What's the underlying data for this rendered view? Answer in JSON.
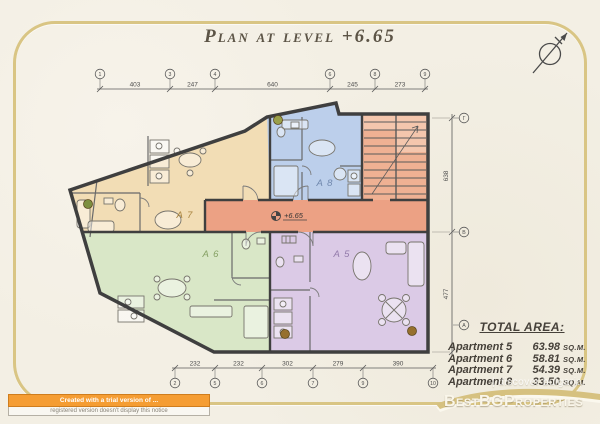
{
  "title": "Plan at level +6.65",
  "plan": {
    "level_marker": "+6.65",
    "apartments": [
      {
        "label": "A 5"
      },
      {
        "label": "A 6"
      },
      {
        "label": "A 7"
      },
      {
        "label": "A 8"
      }
    ]
  },
  "dims": {
    "top": {
      "segments": [
        "403",
        "247",
        "640",
        "245",
        "273"
      ],
      "grid": [
        "1",
        "3",
        "4",
        "6",
        "8",
        "9"
      ]
    },
    "bottom": {
      "segments": [
        "232",
        "232",
        "302",
        "279",
        "390"
      ],
      "grid": [
        "2",
        "5",
        "6",
        "7",
        "9",
        "10"
      ]
    },
    "right": {
      "segments": [
        "638",
        "477"
      ],
      "grid": [
        "Г",
        "В",
        "А"
      ]
    }
  },
  "total_area": {
    "heading": "TOTAL AREA:",
    "rows": [
      {
        "name": "Apartment 5",
        "value": "63.98",
        "unit": "SQ.M."
      },
      {
        "name": "Apartment 6",
        "value": "58.81",
        "unit": "SQ.M."
      },
      {
        "name": "Apartment 7",
        "value": "54.39",
        "unit": "SQ.M."
      },
      {
        "name": "Apartment 8",
        "value": "33.50",
        "unit": "SQ.M."
      }
    ]
  },
  "watermarks": {
    "brand": "BestBGProperties",
    "discover": "| discover bulgaria",
    "trial_line1": "Created with a trial version of ...",
    "trial_line2": "registered version doesn't display this notice"
  },
  "colors": {
    "a5": "#dbcae6",
    "a6": "#d9e7c7",
    "a7": "#f2ddb5",
    "a8": "#bccfeb",
    "corridor": "#eca184",
    "stairs": "#efb193",
    "frame": "#d9c584"
  }
}
